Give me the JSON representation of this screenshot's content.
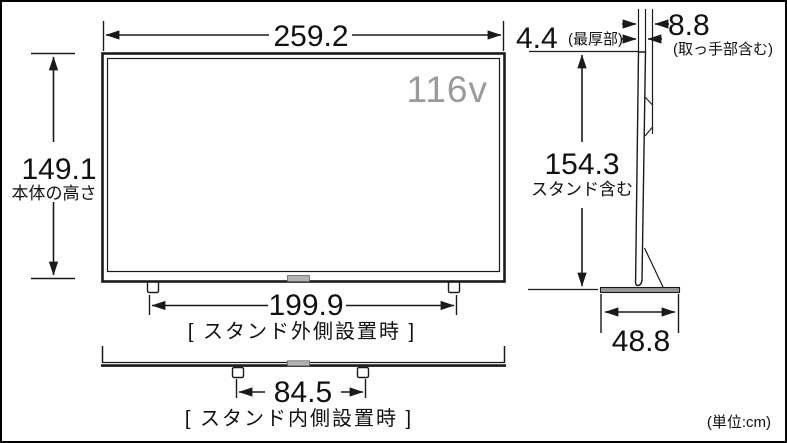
{
  "front_view": {
    "width_value": "259.2",
    "body_height_value": "149.1",
    "body_height_caption": "本体の高さ",
    "screen_size_label": "116v",
    "stand_outer_width_value": "199.9",
    "stand_outer_caption": "[ スタンド外側設置時 ]",
    "stand_inner_width_value": "84.5",
    "stand_inner_caption": "[ スタンド内側設置時 ]"
  },
  "side_view": {
    "thickness_value": "4.4",
    "thickness_caption": "(最厚部)",
    "thickness_with_handle_value": "8.8",
    "thickness_with_handle_caption": "(取っ手部含む)",
    "total_height_value": "154.3",
    "total_height_caption": "スタンド含む",
    "stand_depth_value": "48.8"
  },
  "footer": {
    "unit_note": "(単位:cm)"
  },
  "colors": {
    "line": "#1a1a1a",
    "muted_text": "#9a9a9a",
    "stand_fill": "#999999",
    "tab_fill": "#b3b3b3"
  }
}
